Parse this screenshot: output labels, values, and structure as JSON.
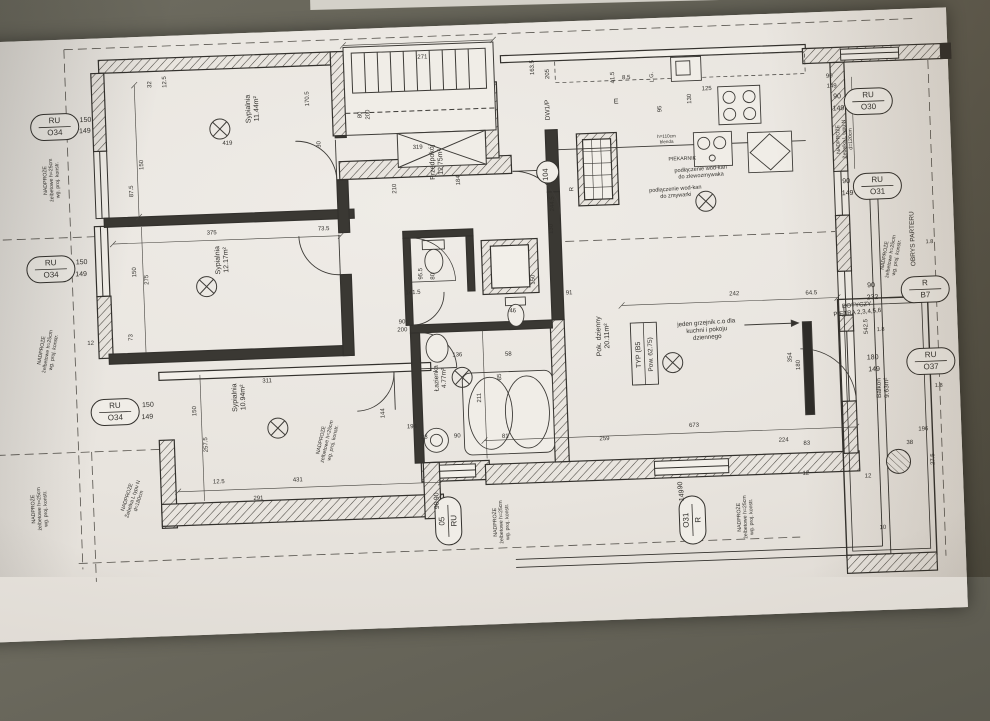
{
  "scene": {
    "description": "photographed architectural floor plan on tilted paper",
    "background_color": "#5e5d52",
    "paper_color": "#e9e5df",
    "ink_color": "#32302c"
  },
  "rooms": [
    {
      "id": "bedroom-1",
      "lines": [
        "Sypialnia",
        "11.44m²"
      ],
      "x": 246,
      "y": 118,
      "rot": -90,
      "size": 7
    },
    {
      "id": "bedroom-2",
      "lines": [
        "Sypialnia",
        "12.17m²"
      ],
      "x": 210,
      "y": 268,
      "rot": -90,
      "size": 7
    },
    {
      "id": "bedroom-3",
      "lines": [
        "Sypialnia",
        "10.94m²"
      ],
      "x": 222,
      "y": 406,
      "rot": -90,
      "size": 7
    },
    {
      "id": "hall",
      "lines": [
        "Przedpokój",
        "12.75m²"
      ],
      "x": 428,
      "y": 178,
      "rot": -90,
      "size": 7
    },
    {
      "id": "bathroom",
      "lines": [
        "Łazienka",
        "4.77m²"
      ],
      "x": 424,
      "y": 394,
      "rot": -90,
      "size": 6.5
    },
    {
      "id": "living-room",
      "lines": [
        "Pok. dzienny",
        "20.11m²"
      ],
      "x": 588,
      "y": 358,
      "rot": -90,
      "size": 7
    },
    {
      "id": "balcony",
      "lines": [
        "Balkon",
        "9.63m²"
      ],
      "x": 866,
      "y": 420,
      "rot": -90,
      "size": 6.5
    }
  ],
  "type_box": {
    "lines": [
      "TYP  (B5",
      "Pow. 62.75)"
    ],
    "x": 631,
    "y": 376,
    "rot": -90,
    "size": 7
  },
  "window_tags": [
    {
      "id": "RU-O34-a",
      "l1": "RU",
      "l2": "O34",
      "x": 50,
      "y": 129,
      "rot": 0,
      "subs": [
        {
          "t": "150",
          "x": 81,
          "y": 125,
          "rot": 0
        },
        {
          "t": "149",
          "x": 80,
          "y": 136,
          "rot": 0
        }
      ]
    },
    {
      "id": "RU-O34-b",
      "l1": "RU",
      "l2": "O34",
      "x": 41,
      "y": 271,
      "rot": 0,
      "subs": [
        {
          "t": "150",
          "x": 72,
          "y": 267,
          "rot": 0
        },
        {
          "t": "149",
          "x": 71,
          "y": 279,
          "rot": 0
        }
      ]
    },
    {
      "id": "RU-O34-c",
      "l1": "RU",
      "l2": "O34",
      "x": 100,
      "y": 416,
      "rot": 0,
      "subs": [
        {
          "t": "150",
          "x": 133,
          "y": 412,
          "rot": 0
        },
        {
          "t": "149",
          "x": 132,
          "y": 424,
          "rot": 0
        }
      ]
    },
    {
      "id": "RU-O30",
      "l1": "RU",
      "l2": "O30",
      "x": 864,
      "y": 133,
      "rot": 0,
      "subs": [
        {
          "t": "90",
          "x": 833,
          "y": 129,
          "rot": 0
        },
        {
          "t": "149",
          "x": 834,
          "y": 141,
          "rot": 0
        }
      ]
    },
    {
      "id": "RU-O31",
      "l1": "RU",
      "l2": "O31",
      "x": 870,
      "y": 218,
      "rot": 0,
      "subs": [
        {
          "t": "90",
          "x": 839,
          "y": 214,
          "rot": 0
        },
        {
          "t": "149",
          "x": 840,
          "y": 226,
          "rot": 0
        }
      ]
    },
    {
      "id": "R-B7",
      "l1": "R",
      "l2": "B7",
      "x": 914,
      "y": 323,
      "rot": 0,
      "subs": [
        {
          "t": "90",
          "x": 860,
          "y": 319,
          "rot": 0
        },
        {
          "t": "232",
          "x": 861,
          "y": 331,
          "rot": 0
        }
      ]
    },
    {
      "id": "RU-O37",
      "l1": "RU",
      "l2": "O37",
      "x": 917,
      "y": 395,
      "rot": 0,
      "subs": [
        {
          "t": "180",
          "x": 859,
          "y": 391,
          "rot": 0
        },
        {
          "t": "149",
          "x": 860,
          "y": 403,
          "rot": 0
        }
      ]
    },
    {
      "id": "05-RU",
      "l1": "05",
      "l2": "RU",
      "x": 429,
      "y": 537,
      "rot": -90,
      "subs": [
        {
          "t": "90",
          "x": 420,
          "y": 512,
          "rot": -90
        },
        {
          "t": "90",
          "x": 420,
          "y": 521,
          "rot": -90
        }
      ]
    },
    {
      "id": "O31-R",
      "l1": "O31",
      "l2": "R",
      "x": 673,
      "y": 545,
      "rot": -90,
      "subs": [
        {
          "t": "90",
          "x": 664,
          "y": 510,
          "rot": -90
        },
        {
          "t": "149",
          "x": 665,
          "y": 520,
          "rot": -90
        }
      ]
    }
  ],
  "circle_tags": [
    {
      "t": "104",
      "x": 541,
      "y": 192,
      "rot": -90
    }
  ],
  "annotations": [
    {
      "id": "lintel-left-1",
      "lines": [
        "NADPROŻE",
        "żelbetowe h=25cm",
        "wg. proj. konstr."
      ],
      "x": 40,
      "y": 182,
      "rot": -90,
      "size": 5.2
    },
    {
      "id": "lintel-left-2",
      "lines": [
        "NADPROŻE",
        "żelbetowe h=25cm",
        "wg. proj. konstr."
      ],
      "x": 30,
      "y": 352,
      "rot": -78,
      "size": 5.2
    },
    {
      "id": "lintel-left-3",
      "lines": [
        "NADPROŻE",
        "żelbetowe h=25cm",
        "wg. proj. konstr."
      ],
      "x": 16,
      "y": 510,
      "rot": -90,
      "size": 5.2
    },
    {
      "id": "lintel-beam-180",
      "lines": [
        "NADPROŻE",
        "Żebelka L typu N",
        "d=180cm"
      ],
      "x": 110,
      "y": 502,
      "rot": -70,
      "size": 5.2
    },
    {
      "id": "lintel-mid",
      "lines": [
        "NADPROŻE",
        "żelbetowe h=25cm",
        "wg. proj. konstr."
      ],
      "x": 306,
      "y": 452,
      "rot": -75,
      "size": 5.2
    },
    {
      "id": "lintel-bottom-1",
      "lines": [
        "NADPROŻE",
        "żelbetowe h=25cm",
        "wg. proj. konstr."
      ],
      "x": 477,
      "y": 540,
      "rot": -90,
      "size": 5.2
    },
    {
      "id": "lintel-bottom-2",
      "lines": [
        "NADPROŻE",
        "żelbetowe h=25cm",
        "wg. proj. konstr."
      ],
      "x": 721,
      "y": 544,
      "rot": -90,
      "size": 5.2
    },
    {
      "id": "lintel-beam-120",
      "lines": [
        "NADPROŻE",
        "Żebelka L typu N",
        "d=120cm"
      ],
      "x": 834,
      "y": 170,
      "rot": -90,
      "size": 5.2
    },
    {
      "id": "lintel-right",
      "lines": [
        "NADPROŻE",
        "żelbetowe h=25cm",
        "wg. proj. konstr."
      ],
      "x": 876,
      "y": 288,
      "rot": -78,
      "size": 5.2
    },
    {
      "id": "ground-floor-outline",
      "lines": [
        "OBRYS PARTERU"
      ],
      "x": 905,
      "y": 272,
      "rot": -90,
      "size": 6.5
    },
    {
      "id": "floors-note",
      "lines": [
        "DOTYCZY",
        "PIĘTRA 2,3,4,5,6"
      ],
      "x": 845,
      "y": 338,
      "rot": -3,
      "size": 6.2
    },
    {
      "id": "radiator-note",
      "lines": [
        "jeden grzejnik c.o dla",
        "kuchni i pokoju",
        "dziennego"
      ],
      "x": 694,
      "y": 350,
      "rot": -2,
      "size": 6.2
    },
    {
      "id": "sink-connection",
      "lines": [
        "podłączenie wod-kan",
        "do zlewozmywaka"
      ],
      "x": 694,
      "y": 196,
      "rot": -2,
      "size": 5.6
    },
    {
      "id": "dishwasher-connection",
      "lines": [
        "podłączenie wod-kan",
        "do zmywarki"
      ],
      "x": 668,
      "y": 215,
      "rot": -2,
      "size": 5.6
    },
    {
      "id": "oven-label",
      "lines": [
        "PIEKARNIK"
      ],
      "x": 676,
      "y": 185,
      "rot": 0,
      "size": 5.2
    },
    {
      "id": "stair-door",
      "lines": [
        "DW1/P"
      ],
      "x": 545,
      "y": 130,
      "rot": -90,
      "size": 6.5
    },
    {
      "id": "appliance-lg",
      "lines": [
        "L.G."
      ],
      "x": 650,
      "y": 101,
      "rot": -90,
      "size": 5.5
    },
    {
      "id": "appliance-e",
      "lines": [
        "E"
      ],
      "x": 612,
      "y": 126,
      "rot": 0,
      "size": 7
    },
    {
      "id": "hood-note",
      "lines": [
        "h=110cm",
        "blenda"
      ],
      "x": 661,
      "y": 162,
      "rot": 0,
      "size": 4.6
    },
    {
      "id": "riser-r",
      "lines": [
        "R"
      ],
      "x": 566,
      "y": 210,
      "rot": -90,
      "size": 6
    },
    {
      "id": "level-1",
      "lines": [
        "1.8"
      ],
      "x": 868,
      "y": 363,
      "rot": 0,
      "size": 5.6
    },
    {
      "id": "level-2",
      "lines": [
        "1.8"
      ],
      "x": 920,
      "y": 277,
      "rot": 0,
      "size": 5.6
    },
    {
      "id": "level-3",
      "lines": [
        "1.8"
      ],
      "x": 924,
      "y": 421,
      "rot": 0,
      "size": 5.6
    }
  ],
  "dims": [
    {
      "t": "419",
      "x": 222,
      "y": 153
    },
    {
      "t": "271",
      "x": 420,
      "y": 74
    },
    {
      "t": "150",
      "x": 137,
      "y": 170,
      "r": -90
    },
    {
      "t": "12.5",
      "x": 163,
      "y": 88,
      "r": -90
    },
    {
      "t": "32",
      "x": 148,
      "y": 90,
      "r": -90
    },
    {
      "t": "30",
      "x": 315,
      "y": 156,
      "r": -90
    },
    {
      "t": "170.5",
      "x": 305,
      "y": 110,
      "r": -90
    },
    {
      "t": "87.5",
      "x": 126,
      "y": 196,
      "r": -90
    },
    {
      "t": "375",
      "x": 203,
      "y": 242
    },
    {
      "t": "73.5",
      "x": 315,
      "y": 242
    },
    {
      "t": "150",
      "x": 126,
      "y": 277,
      "r": -90
    },
    {
      "t": "275",
      "x": 138,
      "y": 285,
      "r": -90
    },
    {
      "t": "73",
      "x": 120,
      "y": 342,
      "r": -90
    },
    {
      "t": "12",
      "x": 78,
      "y": 348
    },
    {
      "t": "311",
      "x": 253,
      "y": 392
    },
    {
      "t": "150",
      "x": 181,
      "y": 418,
      "r": -90
    },
    {
      "t": "257.5",
      "x": 191,
      "y": 452,
      "r": -90
    },
    {
      "t": "431",
      "x": 280,
      "y": 492
    },
    {
      "t": "291",
      "x": 240,
      "y": 509
    },
    {
      "t": "12.5",
      "x": 201,
      "y": 491
    },
    {
      "t": "319",
      "x": 412,
      "y": 164
    },
    {
      "t": "210",
      "x": 389,
      "y": 203,
      "r": -90
    },
    {
      "t": "184",
      "x": 453,
      "y": 197,
      "r": -90
    },
    {
      "t": "141.5",
      "x": 402,
      "y": 309
    },
    {
      "t": "95.5",
      "x": 412,
      "y": 289,
      "r": -90
    },
    {
      "t": "80",
      "x": 424,
      "y": 292,
      "r": -90
    },
    {
      "t": "150",
      "x": 524,
      "y": 299,
      "r": -90
    },
    {
      "t": "46",
      "x": 501,
      "y": 331
    },
    {
      "t": "136",
      "x": 444,
      "y": 373
    },
    {
      "t": "58",
      "x": 495,
      "y": 374
    },
    {
      "t": "85",
      "x": 487,
      "y": 395,
      "r": -90
    },
    {
      "t": "211",
      "x": 466,
      "y": 415,
      "r": -90
    },
    {
      "t": "144",
      "x": 369,
      "y": 427,
      "r": -90
    },
    {
      "t": "23",
      "x": 408,
      "y": 454
    },
    {
      "t": "90",
      "x": 441,
      "y": 454
    },
    {
      "t": "194",
      "x": 396,
      "y": 443
    },
    {
      "t": "81",
      "x": 489,
      "y": 456
    },
    {
      "t": "259",
      "x": 588,
      "y": 462
    },
    {
      "t": "673",
      "x": 678,
      "y": 452
    },
    {
      "t": "224",
      "x": 767,
      "y": 470
    },
    {
      "t": "83",
      "x": 790,
      "y": 474
    },
    {
      "t": "12",
      "x": 788,
      "y": 504
    },
    {
      "t": "242",
      "x": 723,
      "y": 322
    },
    {
      "t": "91",
      "x": 558,
      "y": 315
    },
    {
      "t": "64.5",
      "x": 800,
      "y": 324
    },
    {
      "t": "130",
      "x": 544,
      "y": 249,
      "r": -90
    },
    {
      "t": "244.5",
      "x": 546,
      "y": 224,
      "r": -90
    },
    {
      "t": "125",
      "x": 703,
      "y": 116
    },
    {
      "t": "130",
      "x": 687,
      "y": 124,
      "r": -90
    },
    {
      "t": "95",
      "x": 657,
      "y": 133,
      "r": -90
    },
    {
      "t": "41.5",
      "x": 611,
      "y": 100,
      "r": -90
    },
    {
      "t": "8.5",
      "x": 623,
      "y": 102
    },
    {
      "t": "205",
      "x": 546,
      "y": 94,
      "r": -90
    },
    {
      "t": "163.5",
      "x": 531,
      "y": 87,
      "r": -90
    },
    {
      "t": "90",
      "x": 390,
      "y": 338
    },
    {
      "t": "200",
      "x": 390,
      "y": 346
    },
    {
      "t": "80",
      "x": 357,
      "y": 128,
      "r": -90
    },
    {
      "t": "200",
      "x": 365,
      "y": 128,
      "r": -90
    },
    {
      "t": "38",
      "x": 893,
      "y": 477
    },
    {
      "t": "196",
      "x": 907,
      "y": 464
    },
    {
      "t": "27.5",
      "x": 917,
      "y": 493,
      "r": -90
    },
    {
      "t": "10",
      "x": 863,
      "y": 561
    },
    {
      "t": "12",
      "x": 850,
      "y": 509
    },
    {
      "t": "354",
      "x": 778,
      "y": 386,
      "r": -90
    },
    {
      "t": "180",
      "x": 786,
      "y": 394,
      "r": -90
    },
    {
      "t": "542.5",
      "x": 855,
      "y": 358,
      "r": -90
    },
    {
      "t": "90",
      "x": 826,
      "y": 108
    },
    {
      "t": "149",
      "x": 828,
      "y": 118
    }
  ]
}
